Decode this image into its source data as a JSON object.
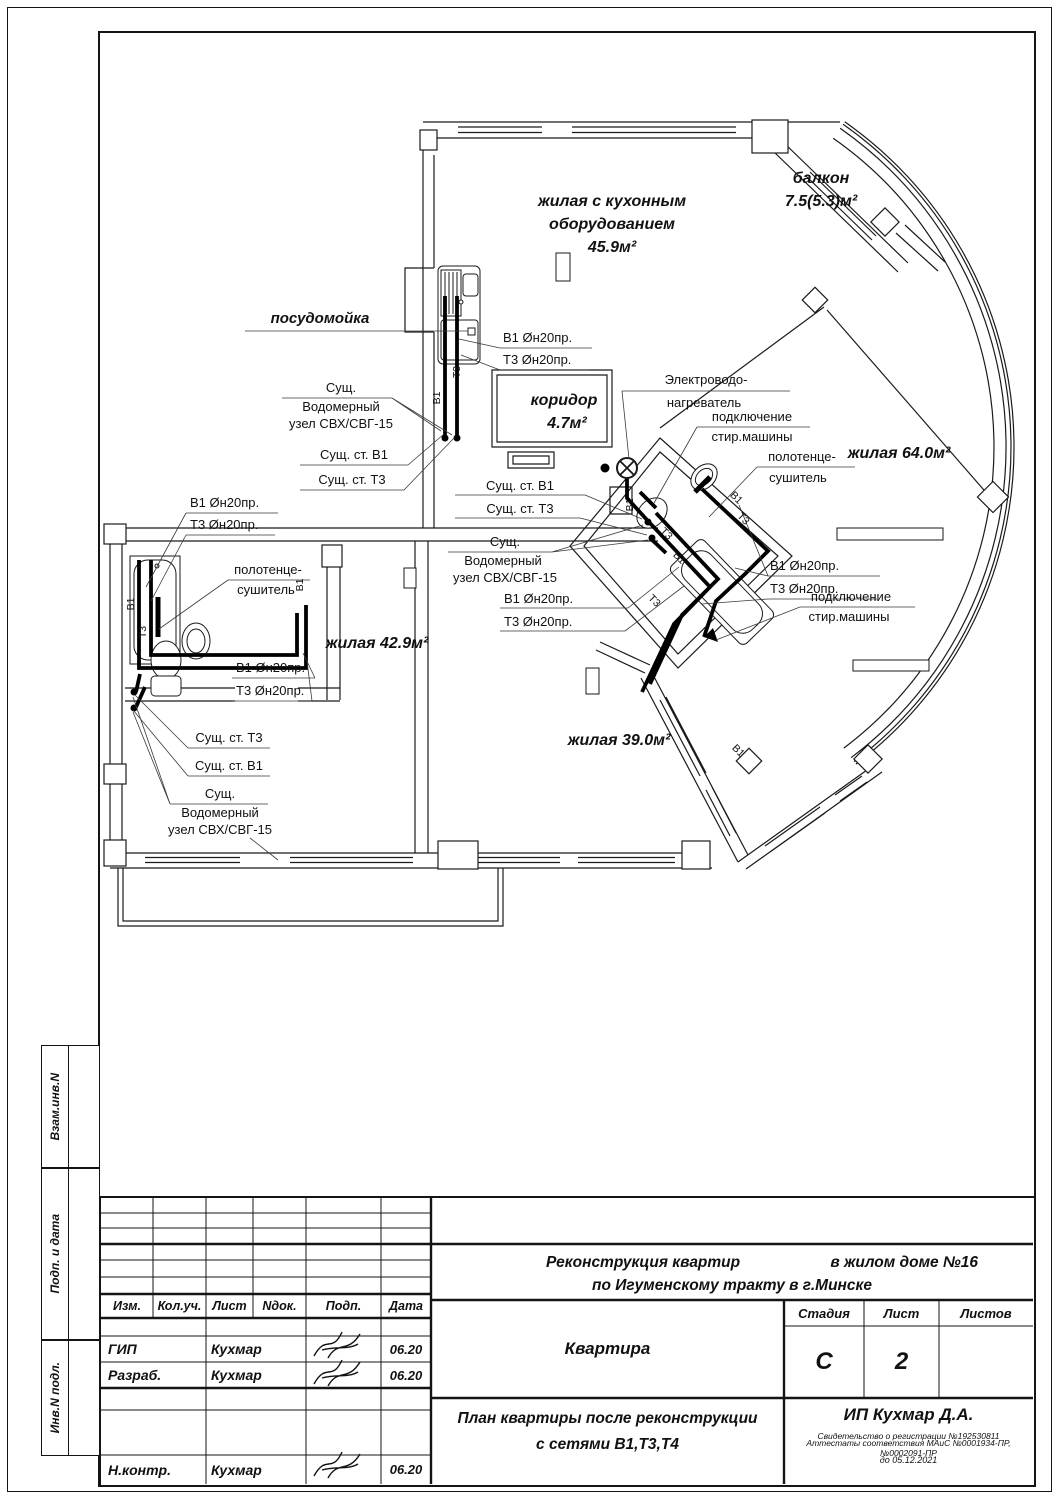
{
  "stamp_side": {
    "vzam": "Взам.инв.N",
    "podp_data": "Подп. и дата",
    "inv_podl": "Инв.N подл."
  },
  "plan": {
    "rooms": {
      "kitchen_line1": "жилая с кухонным",
      "kitchen_line2": "оборудованием",
      "kitchen_area": "45.9м²",
      "balcony_line1": "балкон",
      "balcony_area": "7.5(5.3)м²",
      "room64": "жилая 64.0м²",
      "corridor_line1": "коридор",
      "corridor_area": "4.7м²",
      "room429": "жилая 42.9м²",
      "room390": "жилая 39.0м²"
    },
    "ann": {
      "dishwasher": "посудомойка",
      "pipe_b1": "В1 Øн20пр.",
      "pipe_t3": "Т3 Øн20пр.",
      "exist1": "Сущ.",
      "exist2": "Водомерный",
      "exist3": "узел СВХ/СВГ-15",
      "st_b1": "Сущ. ст. В1",
      "st_t3": "Сущ. ст. Т3",
      "heater1": "Электроводо-",
      "heater2": "нагреватель",
      "washer1": "подключение",
      "washer2": "стир.машины",
      "towel1": "полотенце-",
      "towel2": "сушитель",
      "riser_b1": "В1",
      "riser_t3": "Т3"
    }
  },
  "titleblock": {
    "cols": {
      "izm": "Изм.",
      "kol": "Кол.уч.",
      "list": "Лист",
      "ndok": "Nдок.",
      "podp": "Подп.",
      "data": "Дата"
    },
    "rows": [
      {
        "role": "ГИП",
        "name": "Кухмар",
        "date": "06.20"
      },
      {
        "role": "Разраб.",
        "name": "Кухмар",
        "date": "06.20"
      },
      {
        "role": "Н.контр.",
        "name": "Кухмар",
        "date": "06.20"
      }
    ],
    "project_left": "Реконструкция квартир",
    "project_right": "в жилом доме №16",
    "project_line2": "по Игуменскому тракту в г.Минске",
    "object_name": "Квартира",
    "stage_label": "Стадия",
    "sheet_label": "Лист",
    "sheets_label": "Листов",
    "stage_value": "С",
    "sheet_value": "2",
    "sheets_value": "",
    "title_line1": "План квартиры после реконструкции",
    "title_line2": "с сетями В1,Т3,Т4",
    "company": "ИП Кухмар Д.А.",
    "cert1": "Свидетельство о регистрации №192530811",
    "cert2": "Аттестаты соответствия МАиС №0001934-ПР, №0002091-ПР",
    "cert3": "до 05.12.2021"
  }
}
